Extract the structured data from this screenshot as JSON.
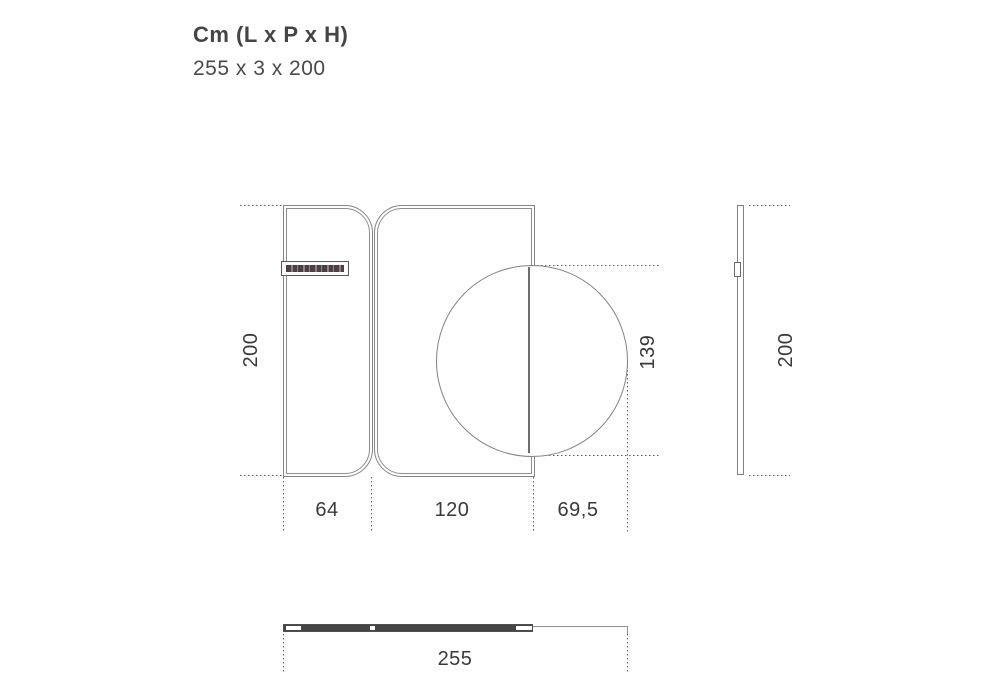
{
  "header": {
    "title": "Cm (L x P x H)",
    "size": "255 x 3 x 200"
  },
  "dimensions": {
    "front_height": "200",
    "left_panel_width": "64",
    "right_panel_width": "120",
    "half_disc_width": "69,5",
    "disc_diameter": "139",
    "side_height": "200",
    "total_width": "255"
  },
  "colors": {
    "line": "#858585",
    "dotted_line": "#5c5c5c",
    "text": "#393939",
    "top_view_fill": "#454545",
    "background": "#ffffff"
  }
}
